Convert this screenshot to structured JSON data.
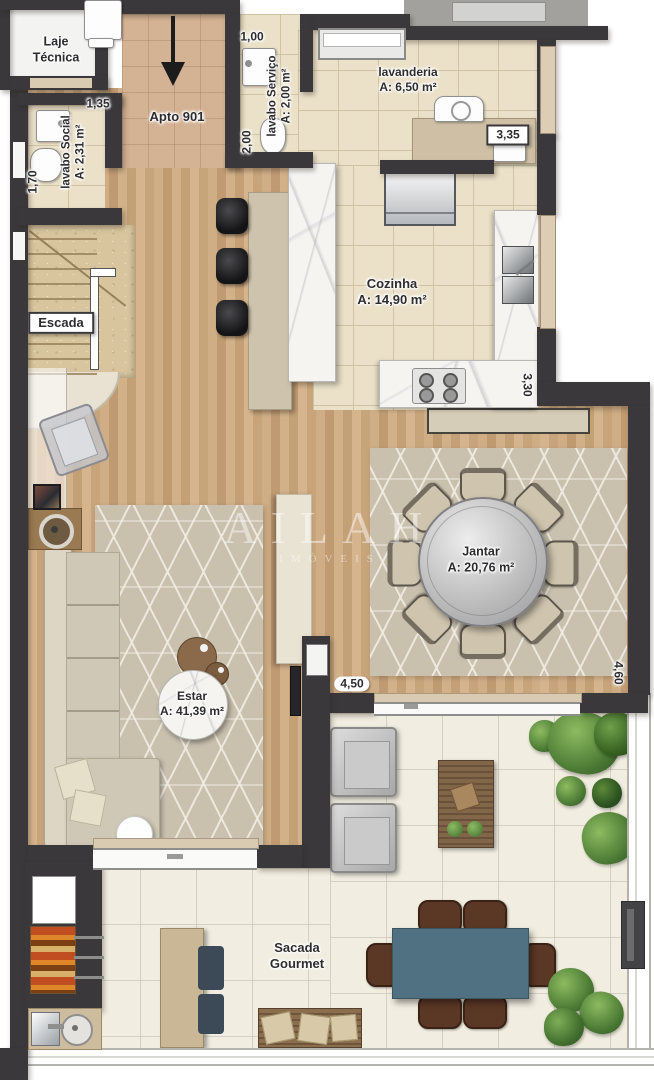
{
  "plan": {
    "unit_label": "Apto 901",
    "watermark": {
      "brand": "AILAH",
      "tagline": "IMÓVEIS"
    },
    "rooms": {
      "laje_tecnica": {
        "line1": "Laje",
        "line2": "Técnica"
      },
      "lavabo_social": {
        "name": "lavabo Social",
        "area": "A: 2,31 m²"
      },
      "lavabo_servico": {
        "name": "lavabo Serviço",
        "area": "A: 2,00 m²"
      },
      "lavanderia": {
        "name": "lavanderia",
        "area": "A: 6,50 m²"
      },
      "escada": {
        "name": "Escada"
      },
      "cozinha": {
        "name": "Cozinha",
        "area": "A: 14,90 m²"
      },
      "jantar": {
        "name": "Jantar",
        "area": "A: 20,76 m²"
      },
      "estar": {
        "name": "Estar",
        "area": "A: 41,39 m²"
      },
      "sacada_gourmet": {
        "line1": "Sacada",
        "line2": "Gourmet"
      }
    },
    "dimensions": {
      "lavabo_social_width": "1,35",
      "lavabo_social_depth": "1,70",
      "lavabo_servico_width": "1,00",
      "lavabo_servico_depth": "2,00",
      "lavanderia_width": "3,35",
      "cozinha_depth": "3,30",
      "sacada_width": "4,50",
      "jantar_depth": "4,60"
    },
    "colors": {
      "wall": "#3a383b",
      "wood_floor": "#c9a77f",
      "tile_floor": "#ebe1c9",
      "balcony_floor": "#f1ede0",
      "rug": "#c9c0ae",
      "outdoor_table": "#4f7181",
      "outdoor_chair": "#5b3826",
      "plant": "#4c7b35"
    }
  }
}
